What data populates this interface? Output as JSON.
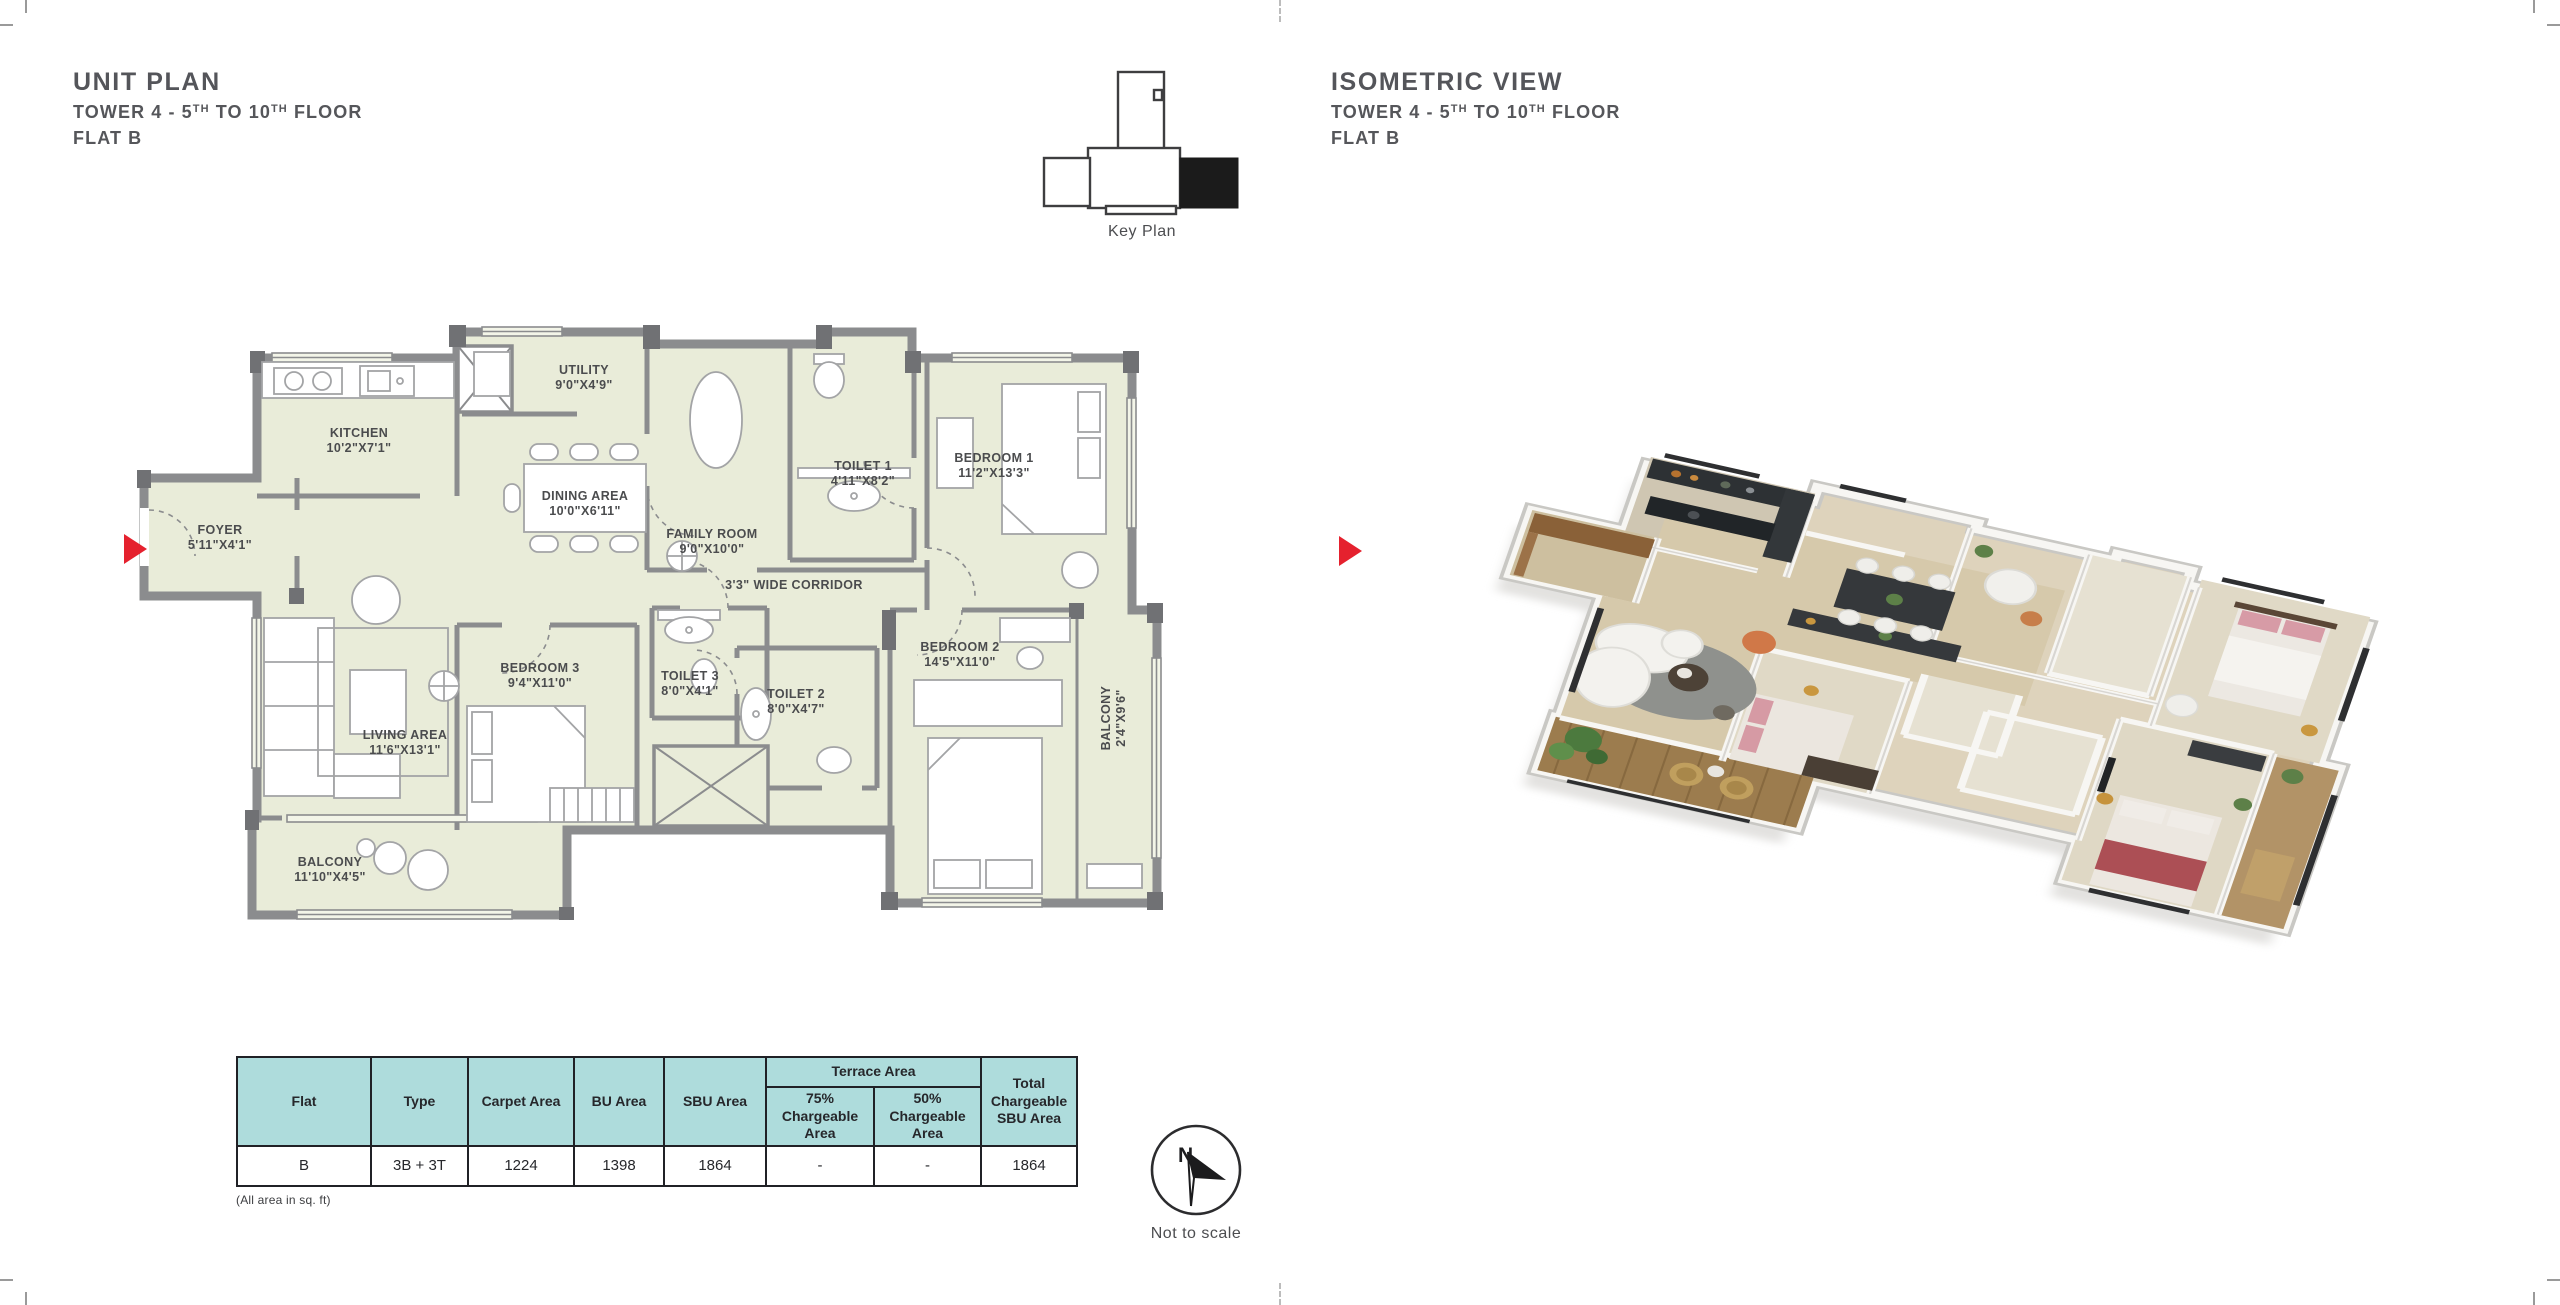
{
  "unit_panel": {
    "title": "UNIT PLAN",
    "subtitle": {
      "p1": "TOWER 4 - 5",
      "s1": "TH",
      "p2": " TO 10",
      "s2": "TH",
      "p3": " FLOOR"
    },
    "flat": "FLAT B"
  },
  "iso_panel": {
    "title": "ISOMETRIC VIEW",
    "subtitle": {
      "p1": "TOWER 4 - 5",
      "s1": "TH",
      "p2": " TO 10",
      "s2": "TH",
      "p3": " FLOOR"
    },
    "flat": "FLAT B"
  },
  "key_plan": {
    "label": "Key Plan"
  },
  "compass": {
    "north": "N",
    "note": "Not to scale"
  },
  "unit_plan": {
    "rooms": [
      {
        "name": "FOYER",
        "size": "5'11\"X4'1\""
      },
      {
        "name": "KITCHEN",
        "size": "10'2\"X7'1\""
      },
      {
        "name": "UTILITY",
        "size": "9'0\"X4'9\""
      },
      {
        "name": "DINING AREA",
        "size": "10'0\"X6'11\""
      },
      {
        "name": "FAMILY ROOM",
        "size": "9'0\"X10'0\""
      },
      {
        "name": "TOILET 1",
        "size": "4'11\"X8'2\""
      },
      {
        "name": "BEDROOM 1",
        "size": "11'2\"X13'3\""
      },
      {
        "name": "3'3\" WIDE CORRIDOR",
        "size": ""
      },
      {
        "name": "BEDROOM 3",
        "size": "9'4\"X11'0\""
      },
      {
        "name": "TOILET 3",
        "size": "8'0\"X4'1\""
      },
      {
        "name": "TOILET 2",
        "size": "8'0\"X4'7\""
      },
      {
        "name": "BEDROOM 2",
        "size": "14'5\"X11'0\""
      },
      {
        "name": "BALCONY",
        "size": "2'4\"X9'6\""
      },
      {
        "name": "LIVING AREA",
        "size": "11'6\"X13'1\""
      },
      {
        "name": "BALCONY",
        "size": "11'10\"X4'5\""
      }
    ]
  },
  "area_table": {
    "headers": {
      "flat": "Flat",
      "type": "Type",
      "carpet": "Carpet Area",
      "bu": "BU Area",
      "sbu": "SBU Area",
      "terrace": "Terrace Area",
      "t75": "75% Chargeable Area",
      "t50": "50% Chargeable Area",
      "total": "Total Chargeable SBU Area"
    },
    "row": {
      "flat": "B",
      "type": "3B + 3T",
      "carpet": "1224",
      "bu": "1398",
      "sbu": "1864",
      "t75": "-",
      "t50": "-",
      "total": "1864"
    },
    "note": "(All area in sq. ft)"
  },
  "colors": {
    "accent_red": "#e5212e",
    "table_header_bg": "#aedcdc",
    "room_fill": "#e9ecd9",
    "wall_gray": "#8b8c8e"
  }
}
